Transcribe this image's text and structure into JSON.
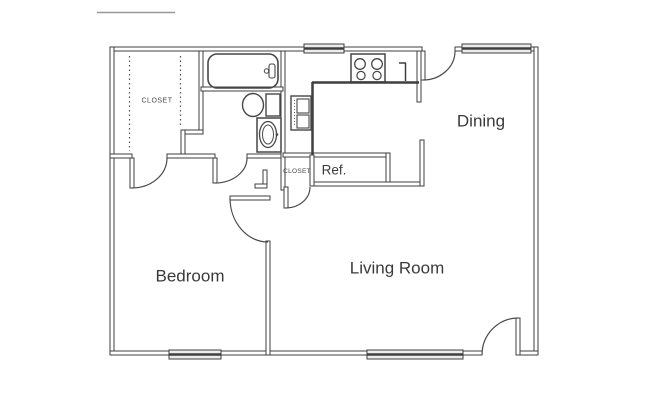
{
  "labels": {
    "bedroom": "Bedroom",
    "living_room": "Living Room",
    "dining": "Dining",
    "walkin_closet": "CLOSET",
    "hall_closet": "CLOSET",
    "refrigerator": "Ref."
  },
  "colors": {
    "wall": "#3f3f3f",
    "arc": "#4a4a4a",
    "text": "#3a3a3a",
    "window_fill": "#ececec",
    "background": "#ffffff"
  },
  "fixtures": [
    "bathtub",
    "toilet",
    "sink-vanity",
    "stove-cooktop",
    "stacked-appliance",
    "refrigerator-nook",
    "closet-rod-dashed-lines"
  ],
  "counts": {
    "windows": 4,
    "door_swings": 6
  }
}
